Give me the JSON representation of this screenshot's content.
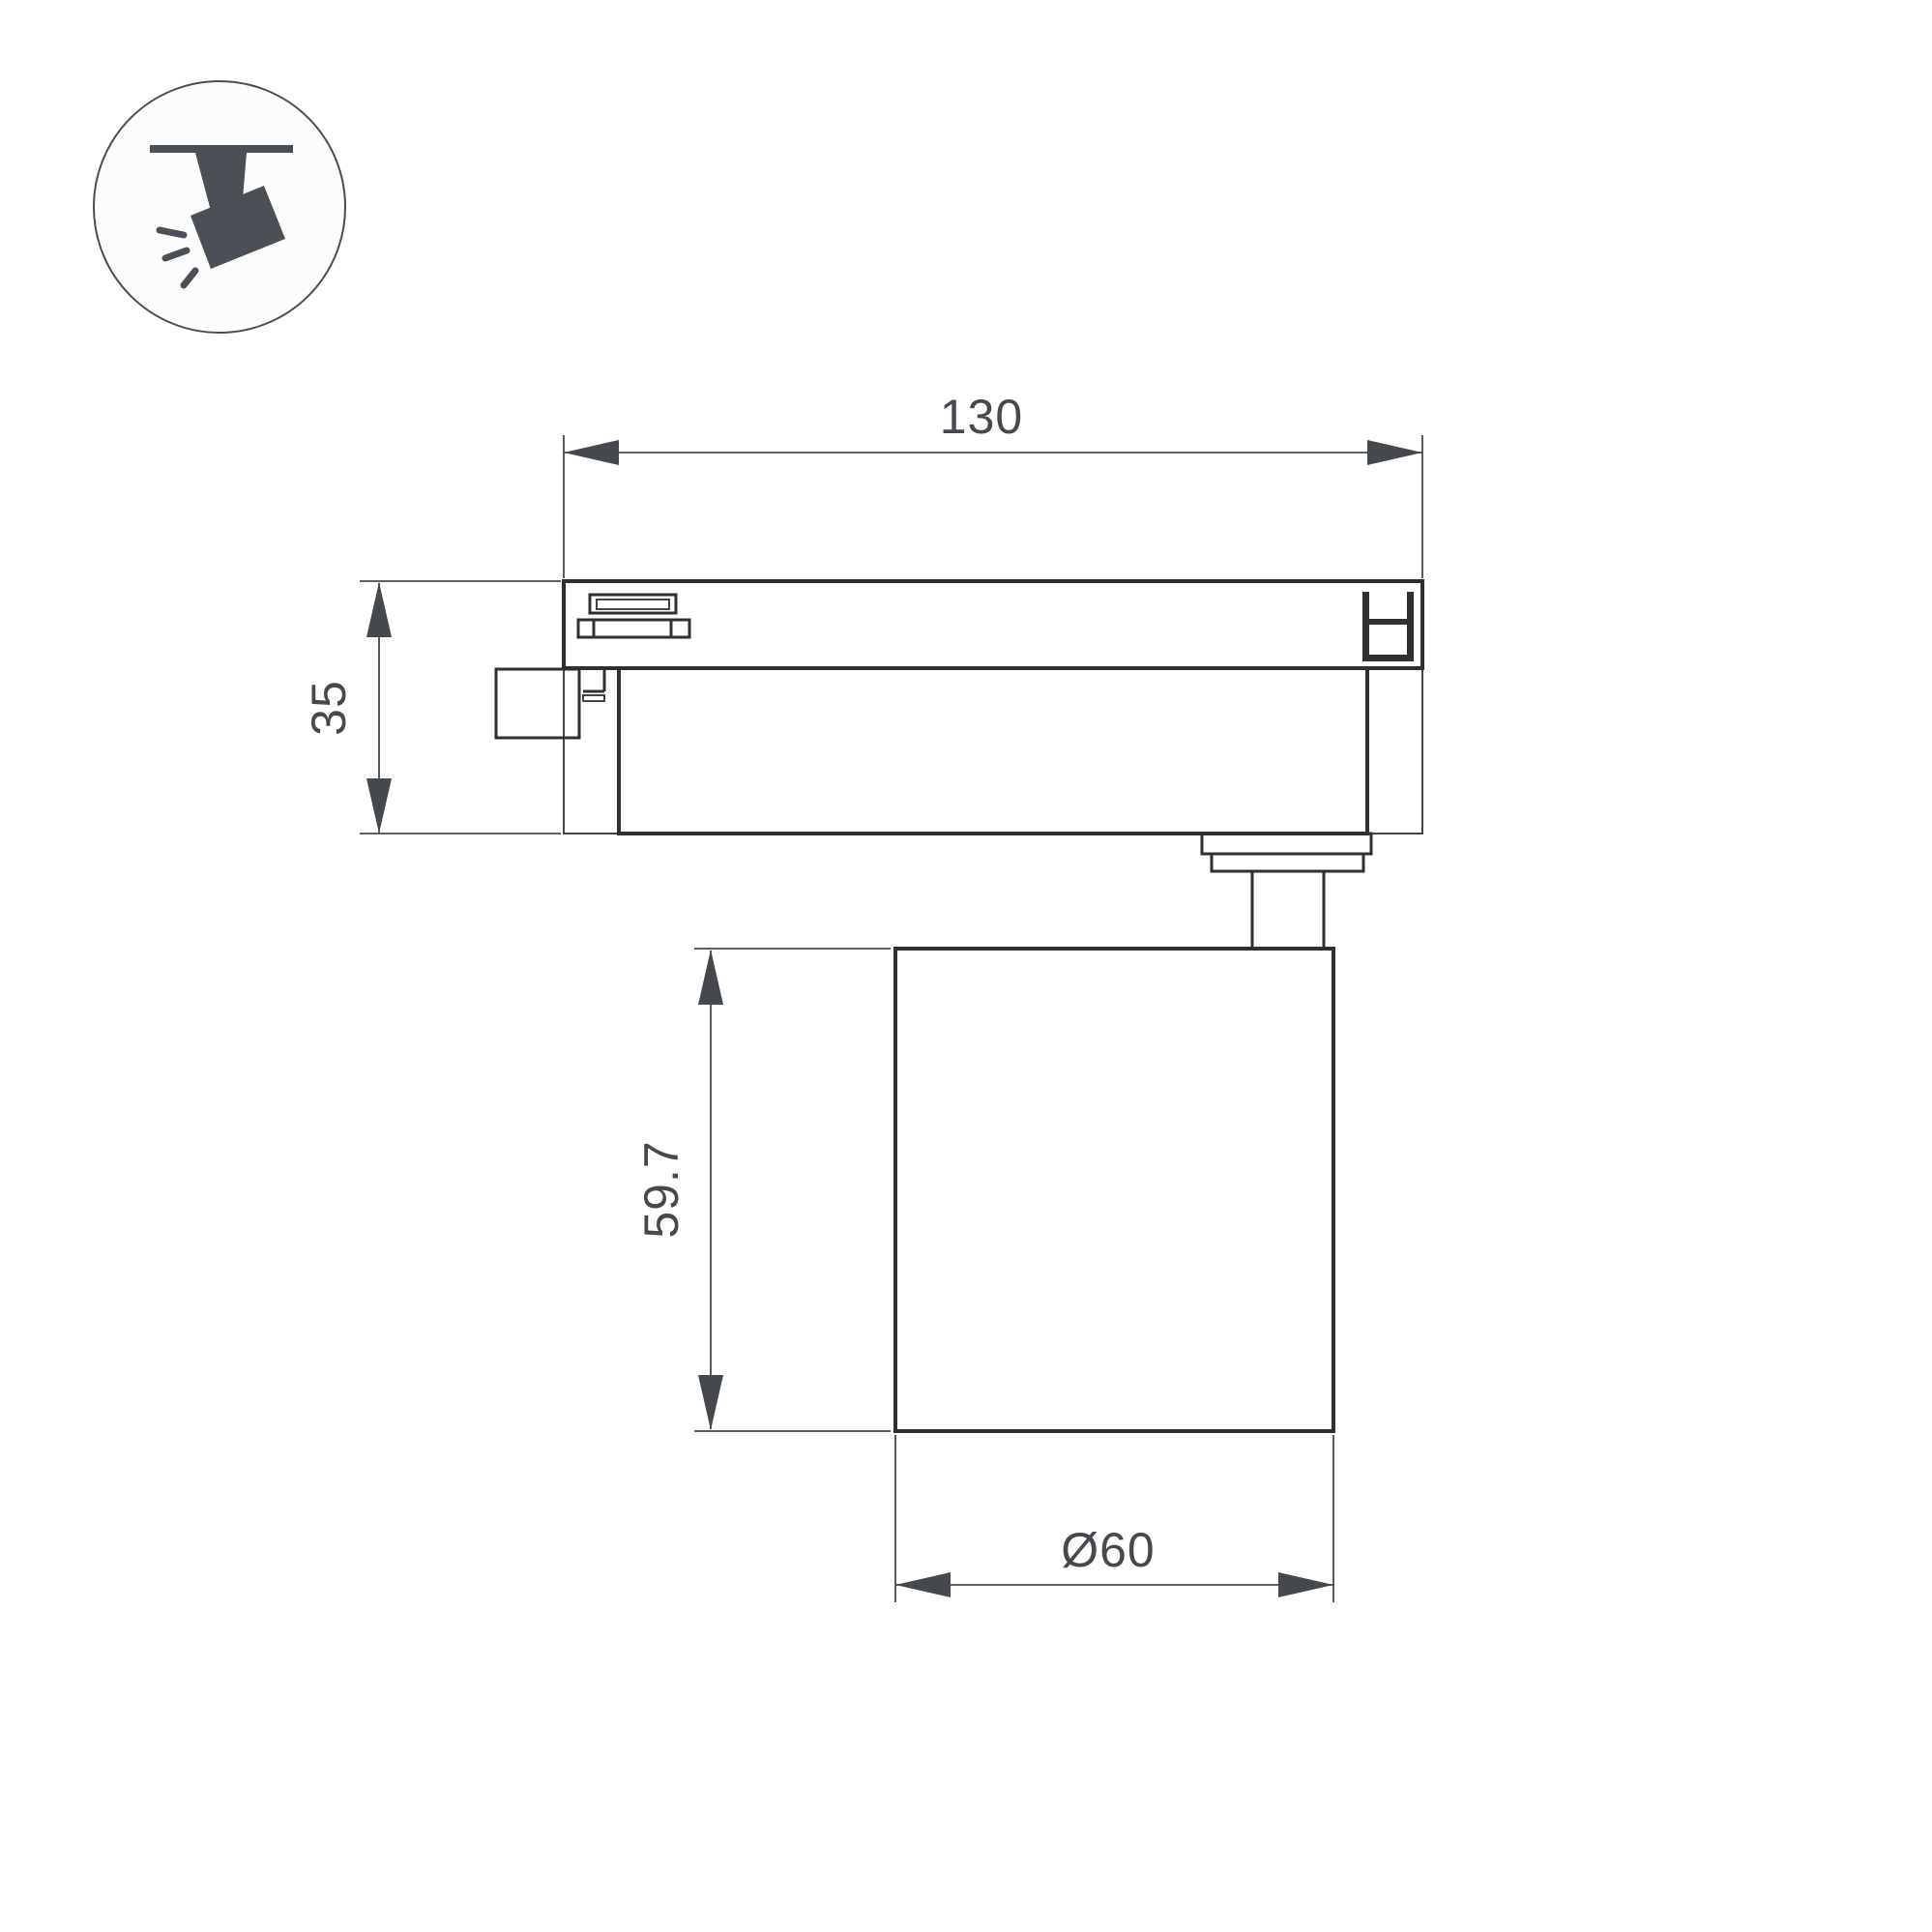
{
  "icon": {
    "label": "track-mounted spotlight pictogram"
  },
  "dims": {
    "track_width": "130",
    "adapter_height": "35",
    "body_height": "59.7",
    "body_diameter": "Ø60"
  },
  "colors": {
    "outline": "#2e3134",
    "dimension": "#45494e",
    "icon_fill": "#4a5056",
    "background": "#ffffff"
  }
}
